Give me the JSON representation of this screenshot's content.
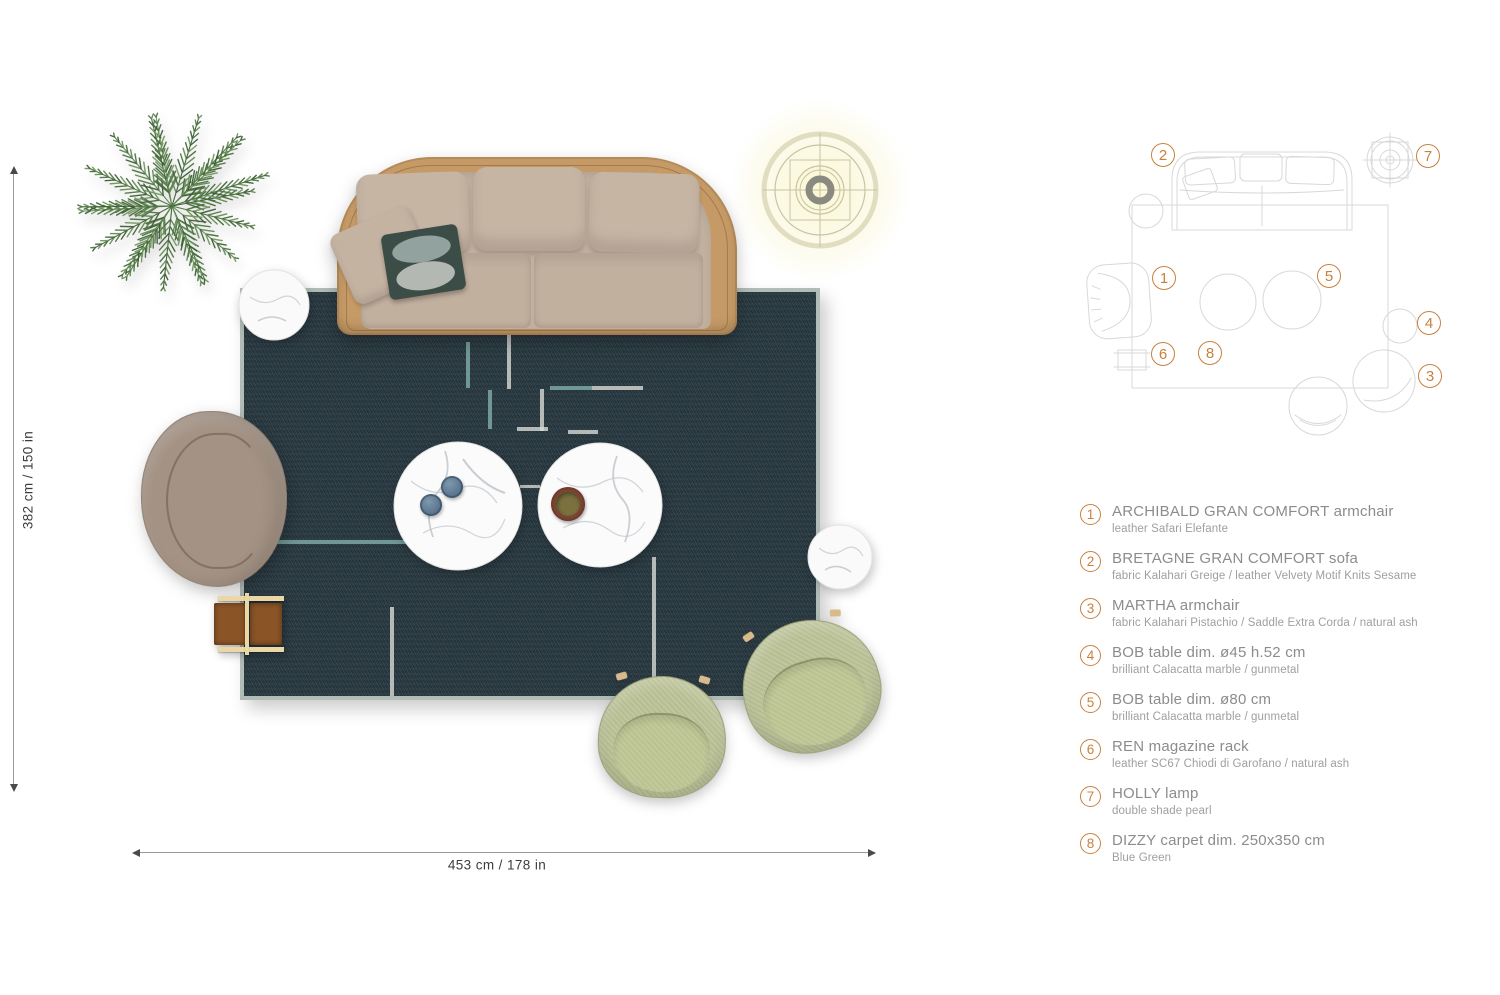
{
  "dimensions": {
    "height_label": "382 cm / 150 in",
    "width_label": "453 cm / 178 in"
  },
  "schematic": {
    "badges": [
      "1",
      "2",
      "3",
      "4",
      "5",
      "6",
      "7",
      "8"
    ]
  },
  "legend": {
    "items": [
      {
        "num": "1",
        "title": "ARCHIBALD GRAN COMFORT armchair",
        "subtitle": "leather Safari Elefante"
      },
      {
        "num": "2",
        "title": "BRETAGNE GRAN COMFORT sofa",
        "subtitle": "fabric Kalahari Greige / leather Velvety Motif Knits Sesame"
      },
      {
        "num": "3",
        "title": "MARTHA armchair",
        "subtitle": "fabric Kalahari Pistachio / Saddle Extra Corda / natural ash"
      },
      {
        "num": "4",
        "title": "BOB table dim. ø45 h.52 cm",
        "subtitle": "brilliant Calacatta marble / gunmetal"
      },
      {
        "num": "5",
        "title": "BOB table dim. ø80 cm",
        "subtitle": "brilliant Calacatta marble / gunmetal"
      },
      {
        "num": "6",
        "title": "REN magazine rack",
        "subtitle": "leather SC67 Chiodi di Garofano / natural ash"
      },
      {
        "num": "7",
        "title": "HOLLY lamp",
        "subtitle": "double shade pearl"
      },
      {
        "num": "8",
        "title": "DIZZY carpet dim. 250x350 cm",
        "subtitle": "Blue Green"
      }
    ]
  },
  "colors": {
    "accent_orange": "#c9803c",
    "carpet_blue_green": "#2b3b43",
    "carpet_pattern_teal": "#7ca7a5",
    "carpet_pattern_white": "#d8dad5",
    "sofa_shell_tan": "#c59a66",
    "sofa_fabric_greige": "#c2b09f",
    "armchair_taupe": "#a49385",
    "martha_pistachio": "#b6bd90",
    "rack_leather_brown": "#8a5426",
    "rack_wood": "#ead7a6",
    "legend_title_gray": "#8c8c8c",
    "schematic_line_gray": "#d8d8d8"
  }
}
